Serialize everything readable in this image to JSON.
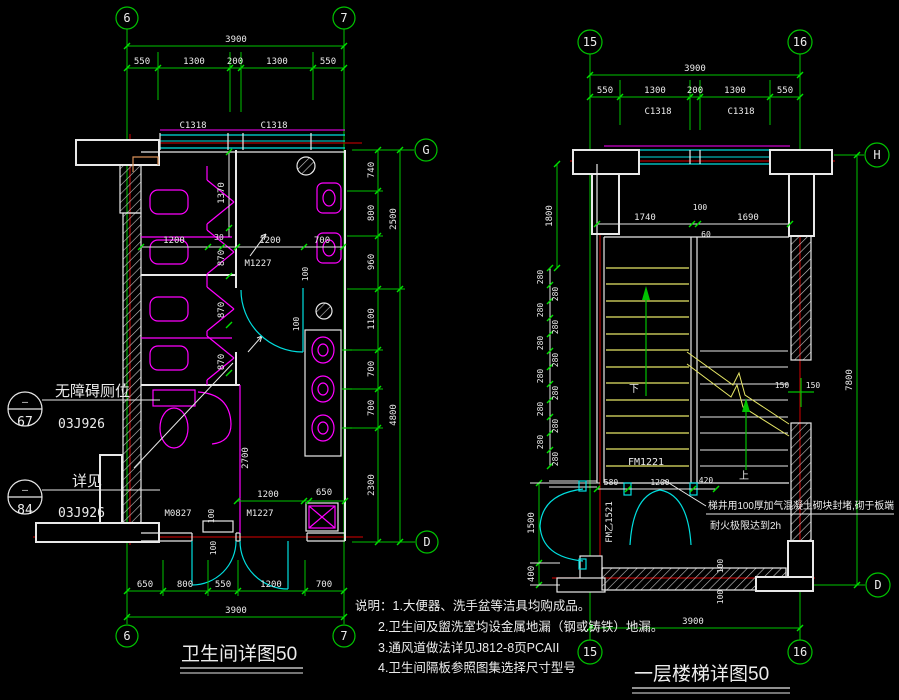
{
  "colors": {
    "background": "#000000",
    "dimension": "#00c300",
    "wall": "#e8e8e8",
    "fixture": "#ff00ff",
    "door": "#00dede",
    "centerline": "#ae0000",
    "stair_tread": "#e6e666",
    "detail_accent": "#d89058"
  },
  "bath": {
    "title": "卫生间详图50",
    "grid": {
      "top_left": "6",
      "top_right": "7",
      "bottom_left": "6",
      "bottom_right": "7",
      "right_top": "G",
      "right_bottom": "D"
    },
    "top_total": "3900",
    "top": [
      "550",
      "1300",
      "200",
      "1300",
      "550"
    ],
    "win": [
      "C1318",
      "C1318"
    ],
    "right_inner": [
      "740",
      "800",
      "960",
      "1100",
      "700",
      "700",
      "2300"
    ],
    "right_outer": [
      "2500",
      "4800"
    ],
    "right_small": "100",
    "mid": [
      "1200",
      "30",
      "1200",
      "700"
    ],
    "stall_vert": [
      "1370",
      "870",
      "870",
      "870"
    ],
    "part": "2700",
    "counter_small": "100",
    "low": [
      "1200",
      "650"
    ],
    "low_small": [
      "100",
      "100"
    ],
    "doors": {
      "top": "M1227",
      "left": "M0827",
      "right": "M1227"
    },
    "bottom": [
      "650",
      "800",
      "550",
      "1200",
      "700"
    ],
    "bottom_total": "3900",
    "ann1": {
      "mark": "—",
      "num": "67",
      "label": "无障碍厕位",
      "ref": "03J926"
    },
    "ann2": {
      "mark": "—",
      "num": "84",
      "label": "详见",
      "ref": "03J926"
    }
  },
  "stair": {
    "title": "一层楼梯详图50",
    "grid": {
      "top_left": "15",
      "top_right": "16",
      "bottom_left": "15",
      "bottom_right": "16",
      "right_top": "H",
      "right_bottom": "D"
    },
    "top_total": "3900",
    "top": [
      "550",
      "1300",
      "200",
      "1300",
      "550"
    ],
    "win": [
      "C1318",
      "C1318"
    ],
    "landing": [
      "1740",
      "100",
      "60",
      "1690"
    ],
    "left_1800": "1800",
    "tread": "280",
    "left_1500": "1500",
    "left_400": "400",
    "right_7800": "7800",
    "shaft_150a": "150",
    "shaft_150b": "150",
    "bottom_chain": [
      "580",
      "1200",
      "420"
    ],
    "wall_small": [
      "100",
      "100"
    ],
    "bottom_total": "3900",
    "up": "上",
    "down": "下",
    "door_fm1221": "FM1221",
    "door_fm1521": "FM乙1521",
    "note1": "梯井用100厚加气混凝土砌块封堵,砌于板端",
    "note2": "耐火极限达到2h"
  },
  "notes": {
    "line1": "说明：1.大便器、洗手盆等洁具均购成品。",
    "line2": "2.卫生间及盥洗室均设金属地漏（钢或铸铁）地漏。",
    "line3": "3.通风道做法详见J812-8页PCAII",
    "line4": "4.卫生间隔板参照图集选择尺寸型号"
  }
}
